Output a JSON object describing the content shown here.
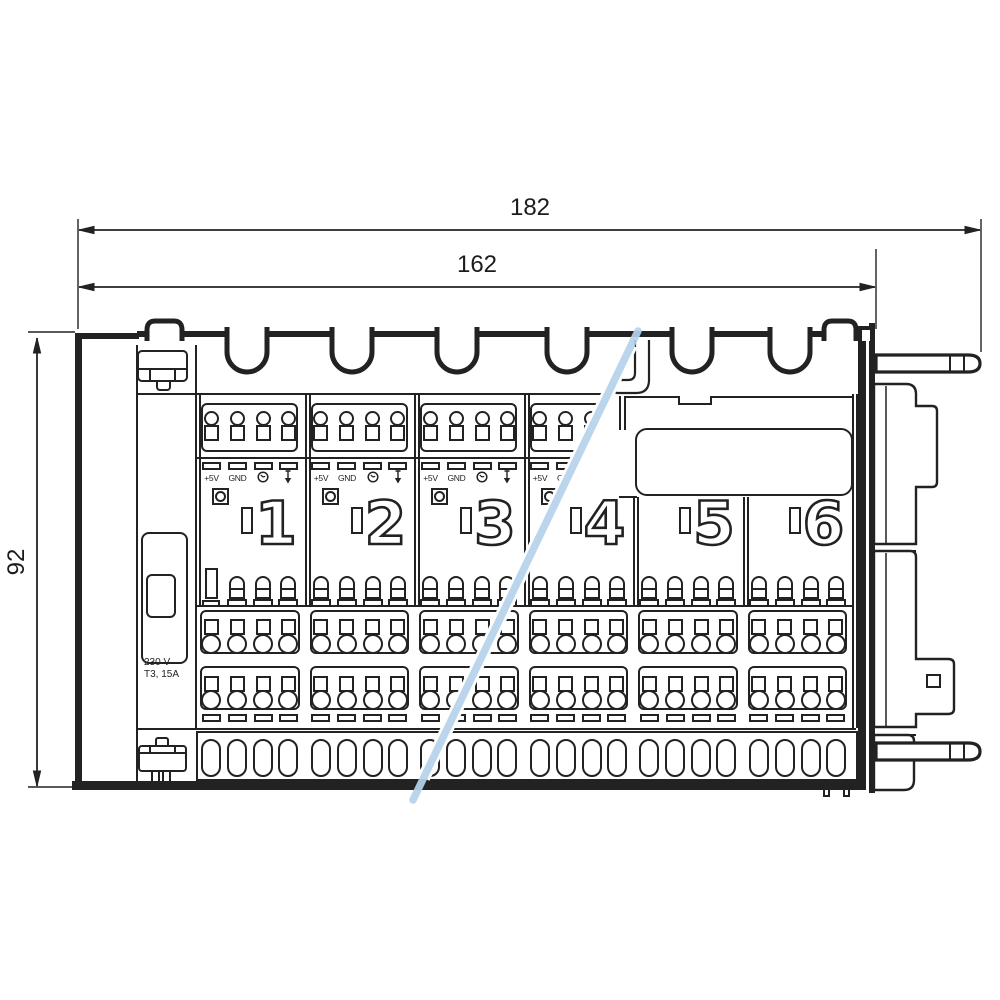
{
  "title": "heating-actuator-dimension-drawing",
  "dimensions": {
    "total_width": "182",
    "rail_width": "162",
    "height": "92"
  },
  "left_panel": {
    "fuse_line1": "230 V",
    "fuse_line2": "T3, 15A"
  },
  "modules": {
    "plus5v_label": "+5V",
    "gnd_label": "GND",
    "icon_names": [
      "clock-icon",
      "down-arrow-icon"
    ],
    "items": [
      {
        "number": "1",
        "top_detail": "full",
        "button": true,
        "pins": "tall-first"
      },
      {
        "number": "2",
        "top_detail": "full",
        "button": true,
        "pins": "standard"
      },
      {
        "number": "3",
        "top_detail": "full",
        "button": true,
        "pins": "standard"
      },
      {
        "number": "4",
        "top_detail": "clipped",
        "button": true,
        "pins": "standard"
      },
      {
        "number": "5",
        "top_detail": "none",
        "button": false,
        "pins": "standard"
      },
      {
        "number": "6",
        "top_detail": "none",
        "button": false,
        "pins": "standard"
      }
    ]
  },
  "colors": {
    "line": "#222222",
    "break_line": "#b5d1ec"
  }
}
